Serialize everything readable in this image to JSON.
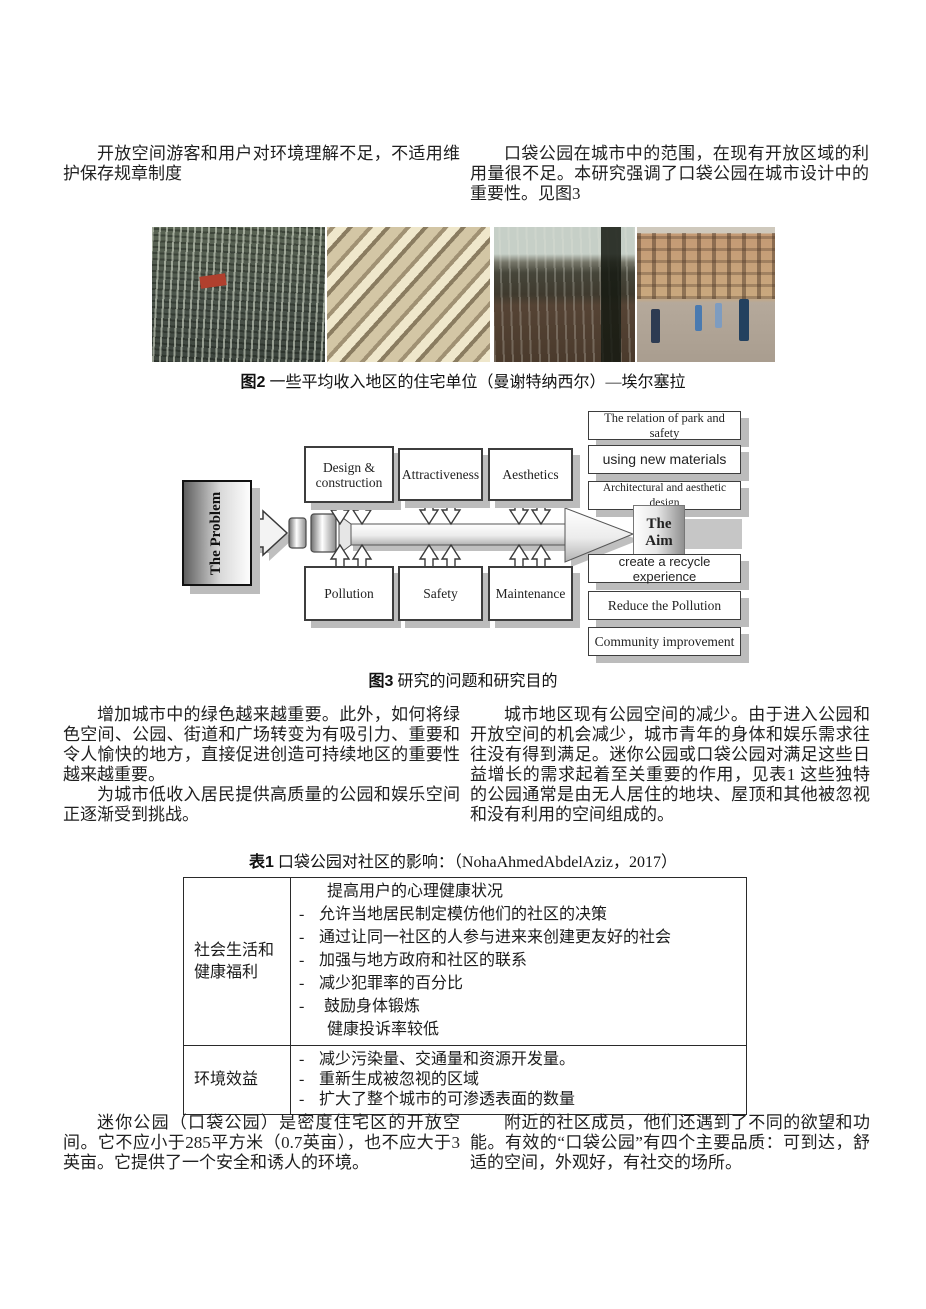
{
  "intro": {
    "left": "开放空间游客和用户对环境理解不足，不适用维护保存规章制度",
    "right": "口袋公园在城市中的范围，在现有开放区域的利用量很不足。本研究强调了口袋公园在城市设计中的重要性。见图3"
  },
  "fig2": {
    "label": "图2",
    "caption": "一些平均收入地区的住宅单位（曼谢特纳西尔）—埃尔塞拉",
    "photos": [
      "dense-city-aerial-photo",
      "housing-blocks-aerial-photo",
      "vacant-lot-street-photo",
      "courtyard-people-photo"
    ]
  },
  "diagram": {
    "problem": "The Problem",
    "aim": "The Aim",
    "top": [
      "Design & construction",
      "Attractiveness",
      "Aesthetics"
    ],
    "bottom": [
      "Pollution",
      "Safety",
      "Maintenance"
    ],
    "aims": [
      "The relation of park and safety",
      "using new materials",
      "Architectural and aesthetic design",
      "create a recycle experience",
      "Reduce the Pollution",
      "Community improvement"
    ]
  },
  "fig3": {
    "label": "图3",
    "caption": "研究的问题和研究目的"
  },
  "body": {
    "left_p1": "增加城市中的绿色越来越重要。此外，如何将绿色空间、公园、街道和广场转变为有吸引力、重要和令人愉快的地方，直接促进创造可持续地区的重要性越来越重要。",
    "left_p2": "为城市低收入居民提供高质量的公园和娱乐空间正逐渐受到挑战。",
    "right_p1": "城市地区现有公园空间的减少。由于进入公园和开放空间的机会减少，城市青年的身体和娱乐需求往往没有得到满足。迷你公园或口袋公园对满足这些日益增长的需求起着至关重要的作用，见表1 这些独特的公园通常是由无人居住的地块、屋顶和其他被忽视和没有利用的空间组成的。"
  },
  "table1": {
    "label": "表1",
    "caption": "口袋公园对社区的影响：（NohaAhmedAbdelAziz，2017）",
    "rows": [
      {
        "category": "社会生活和健康福利",
        "items": [
          {
            "bullet": "",
            "text": "提高用户的心理健康状况"
          },
          {
            "bullet": "-",
            "text": "允许当地居民制定模仿他们的社区的决策"
          },
          {
            "bullet": "-",
            "text": "通过让同一社区的人参与进来来创建更友好的社会"
          },
          {
            "bullet": "-",
            "text": "加强与地方政府和社区的联系"
          },
          {
            "bullet": "-",
            "text": "减少犯罪率的百分比"
          },
          {
            "bullet": "-",
            "text": "鼓励身体锻炼"
          },
          {
            "bullet": "",
            "text": "健康投诉率较低"
          }
        ]
      },
      {
        "category": "环境效益",
        "items": [
          {
            "bullet": "-",
            "text": "减少污染量、交通量和资源开发量。"
          },
          {
            "bullet": "-",
            "text": "重新生成被忽视的区域"
          },
          {
            "bullet": "-",
            "text": "扩大了整个城市的可渗透表面的数量"
          }
        ]
      }
    ]
  },
  "footer": {
    "left": "迷你公园（口袋公园）是密度住宅区的开放空间。它不应小于285平方米（0.7英亩），也不应大于3英亩。它提供了一个安全和诱人的环境。",
    "right": "附近的社区成员，他们还遇到了不同的欲望和功能。有效的“口袋公园”有四个主要品质：可到达，舒适的空间，外观好，有社交的场所。"
  }
}
